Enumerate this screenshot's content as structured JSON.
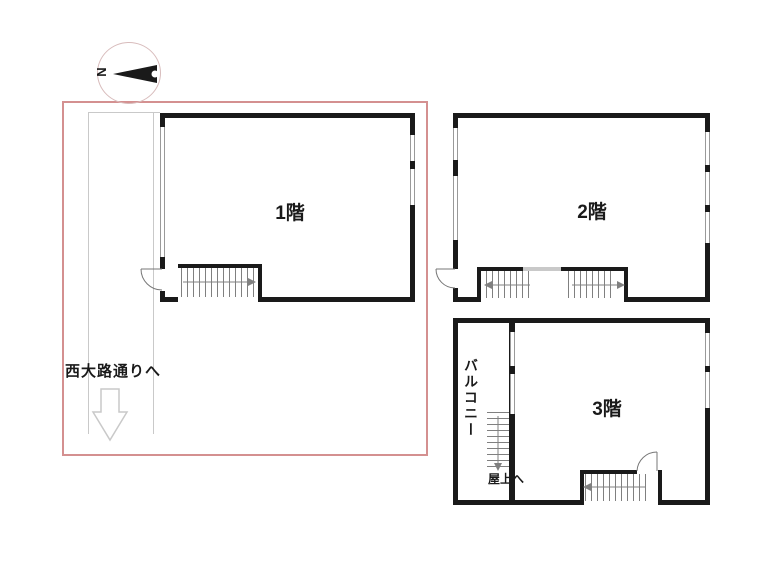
{
  "compass": {
    "north_label": "N"
  },
  "site": {
    "street_label": "西大路通りへ"
  },
  "floors": {
    "f1": {
      "label": "1階"
    },
    "f2": {
      "label": "2階"
    },
    "f3": {
      "label": "3階",
      "balcony_label": "バルコニー",
      "roof_label": "屋上へ"
    }
  },
  "colors": {
    "wall": "#1a1a1a",
    "site_boundary": "#d49090",
    "path_gray": "#c9c9c9",
    "stair_line": "#808080",
    "compass_ring": "#d8bcbc"
  }
}
